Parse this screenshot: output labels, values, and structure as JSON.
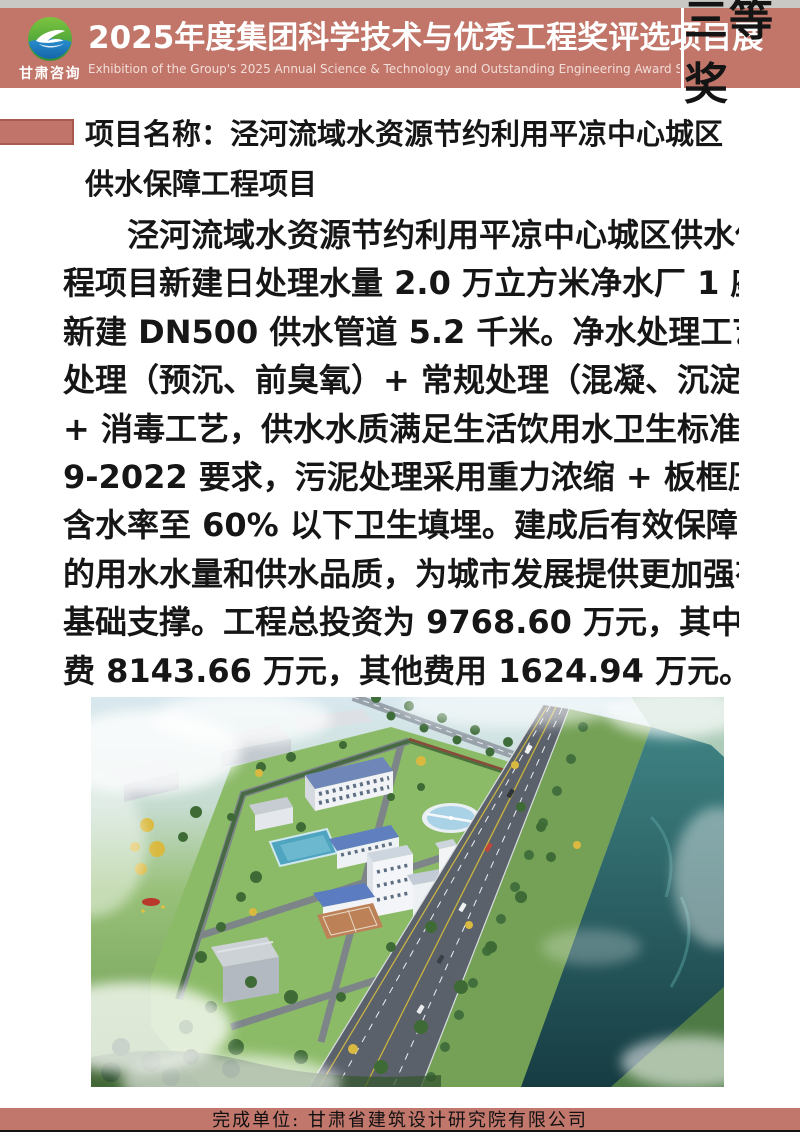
{
  "colors": {
    "top_strip": "#c9c8c4",
    "banner": "#c17669",
    "bullet": "#c0746a",
    "footer_band": "#c1776c"
  },
  "header": {
    "logo_org": "甘肃咨询",
    "title": "2025年度集团科学技术与优秀工程奖评选项目展",
    "subtitle_en": "Exhibition of the Group's 2025 Annual Science & Technology and Outstanding Engineering Award Selection Project",
    "award": "三等奖"
  },
  "project": {
    "name_line1": "项目名称：泾河流域水资源节约利用平凉中心城区",
    "name_line2": "供水保障工程项目",
    "description_lines": [
      "泾河流域水资源节约利用平凉中心城区供水保障工",
      "程项目新建日处理水量 2.0 万立方米净水厂 1 座，配套",
      "新建 DN500 供水管道 5.2 千米。净水处理工艺采用预",
      "处理（预沉、前臭氧）+ 常规处理（混凝、沉淀、过滤）",
      "+ 消毒工艺，供水水质满足生活饮用水卫生标准 GB574",
      "9-2022 要求，污泥处理采用重力浓缩 + 板框压滤工艺，",
      "含水率至 60% 以下卫生填埋。建成后有效保障了城区",
      "的用水水量和供水品质，为城市发展提供更加强有力的",
      "基础支撑。工程总投资为 9768.60 万元，其中：工程",
      "费 8143.66 万元，其他费用 1624.94 万元。"
    ]
  },
  "footer": {
    "completing_unit": "完成单位: 甘肃省建筑设计研究院有限公司"
  }
}
